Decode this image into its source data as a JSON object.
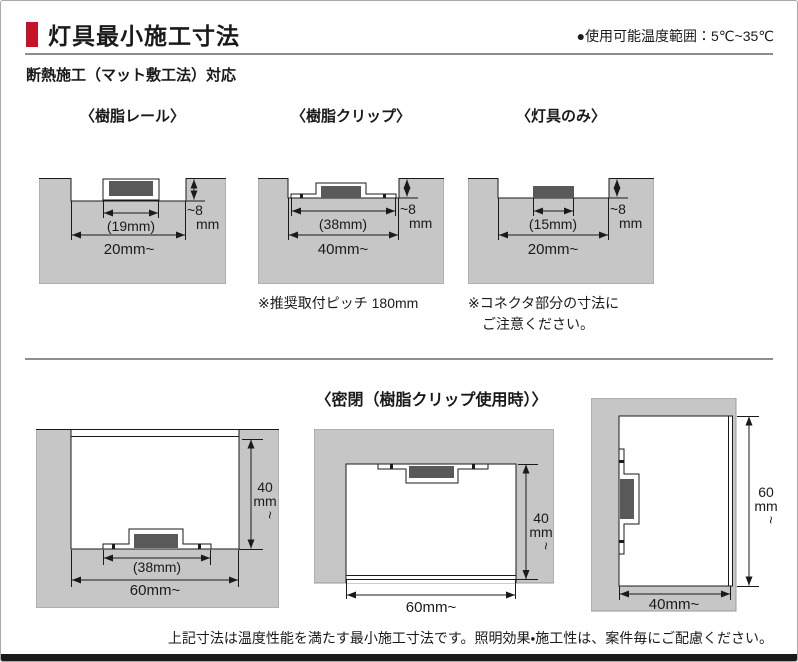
{
  "page": {
    "title": "灯具最小施工寸法",
    "temp_range_note": "●使用可能温度範囲：5℃~35℃",
    "subheader": "断熱施工（マット敷工法）対応",
    "footer_note": "上記寸法は温度性能を満たす最小施工寸法です。照明効果・施工性は、案件毎にご配慮ください。"
  },
  "colors": {
    "accent_red": "#c3142a",
    "insulation_gray": "#c6c6c6",
    "fixture_dark_gray": "#58595b",
    "line_black": "#1a1a1a"
  },
  "top_diagrams": [
    {
      "label": "〈樹脂レール〉",
      "fixture_width": "(19mm)",
      "opening_width": "20mm~",
      "depth": "~8",
      "depth_unit": "mm"
    },
    {
      "label": "〈樹脂クリップ〉",
      "fixture_width": "(38mm)",
      "opening_width": "40mm~",
      "depth": "~8",
      "depth_unit": "mm",
      "note": "※推奨取付ピッチ 180mm"
    },
    {
      "label": "〈灯具のみ〉",
      "fixture_width": "(15mm)",
      "opening_width": "20mm~",
      "depth": "~8",
      "depth_unit": "mm",
      "note_line1": "※コネクタ部分の寸法に",
      "note_line2": "ご注意ください。"
    }
  ],
  "sealed_section": {
    "title": "〈密閉（樹脂クリップ使用時）〉",
    "diagrams": [
      {
        "fixture_width": "(38mm)",
        "opening_width": "60mm~",
        "height": "40",
        "height_unit": "mm",
        "height_cont": "~"
      },
      {
        "opening_width": "60mm~",
        "height": "40",
        "height_unit": "mm",
        "height_cont": "~"
      },
      {
        "opening_width": "40mm~",
        "height": "60",
        "height_unit": "mm",
        "height_cont": "~"
      }
    ]
  }
}
